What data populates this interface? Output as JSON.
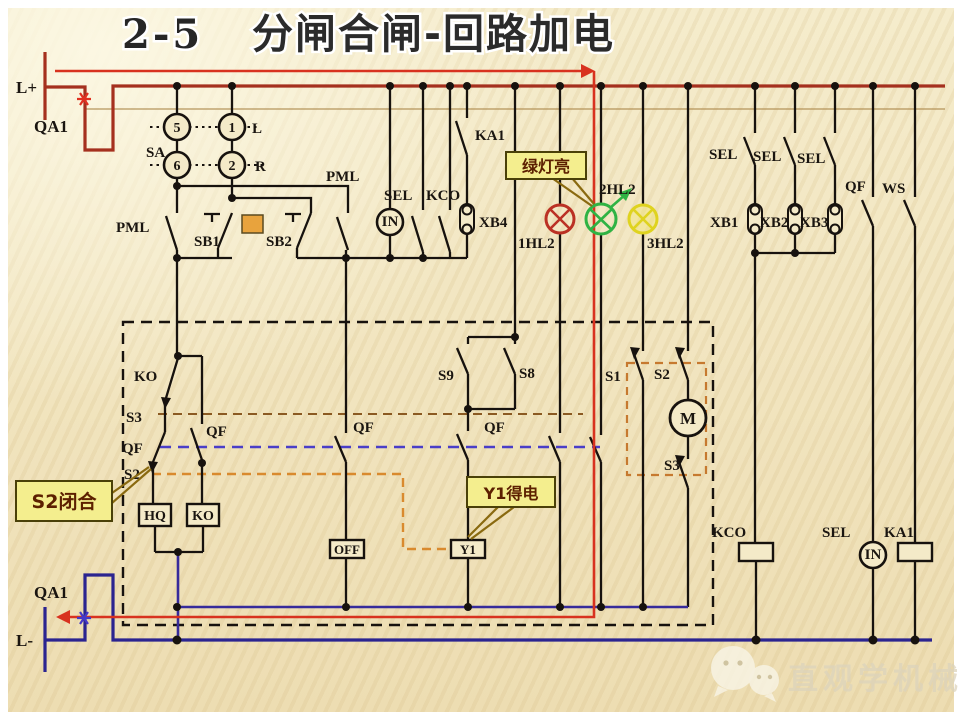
{
  "title": {
    "num": "2-5",
    "text": "分闸合闸-回路加电"
  },
  "rails": {
    "l_plus": "L+",
    "l_minus": "L-",
    "qa1_top": "QA1",
    "qa1_bottom": "QA1"
  },
  "sa": {
    "label": "SA",
    "t5": "5",
    "t6": "6",
    "t1": "1",
    "t2": "2",
    "left": "L",
    "right": "R"
  },
  "row1": {
    "pml_left": "PML",
    "sb1": "SB1",
    "sb2": "SB2",
    "pml_right": "PML",
    "in": "IN",
    "sel": "SEL",
    "kco": "KCO",
    "ka1": "KA1",
    "xb4": "XB4"
  },
  "lamps": {
    "hl1": "1HL2",
    "hl2": "2HL2",
    "hl3": "3HL2"
  },
  "right_top": {
    "sel1": "SEL",
    "sel2": "SEL",
    "sel3": "SEL",
    "xb1": "XB1",
    "xb2": "XB2",
    "xb3": "XB3",
    "qf": "QF",
    "ws": "WS"
  },
  "interlock": {
    "ko_contact": "KO",
    "s3": "S3",
    "qf_a": "QF",
    "s2": "S2",
    "qf_sub": "QF",
    "qf_mid": "QF",
    "qf_right": "QF",
    "s9": "S9",
    "s8": "S8",
    "s1": "S1",
    "s2_b": "S2",
    "s3_b": "S3",
    "m": "M",
    "hq_coil": "HQ",
    "ko_coil": "KO",
    "off_coil": "OFF",
    "y1_coil": "Y1"
  },
  "bottom_right": {
    "kco": "KCO",
    "sel": "SEL",
    "in": "IN",
    "ka1": "KA1"
  },
  "callouts": {
    "green_lamp": "绿灯亮",
    "s2_closed": "S2闭合",
    "y1_energized": "Y1得电"
  },
  "watermark": {
    "text": "直观学机械"
  },
  "colors": {
    "positive_rail": "#A5301E",
    "negative_rail": "#2B2490",
    "return_line": "#372B9B",
    "highlight_path": "#D8321F",
    "wire": "#17120E",
    "qf_link_dash": "#4A3EC8",
    "s3_link_dash": "#8B5A22",
    "s2_link_dash": "#D98A2E",
    "group_box_dash": "#C6792F",
    "box_dash": "#17120E",
    "callout_bg": "#F4EE8E",
    "callout_border": "#4a4008",
    "callout_text": "#5C2000",
    "callout_tail": "#8A6A10",
    "lamp_red": "#BB3124",
    "lamp_green": "#2FB344",
    "lamp_yellow": "#DFD31F",
    "indicator_fill": "#E8A33D",
    "closed_mark_red": "#E03020",
    "closed_mark_blue": "#4538C8",
    "thin_rail_line": "#AD8B4D"
  }
}
